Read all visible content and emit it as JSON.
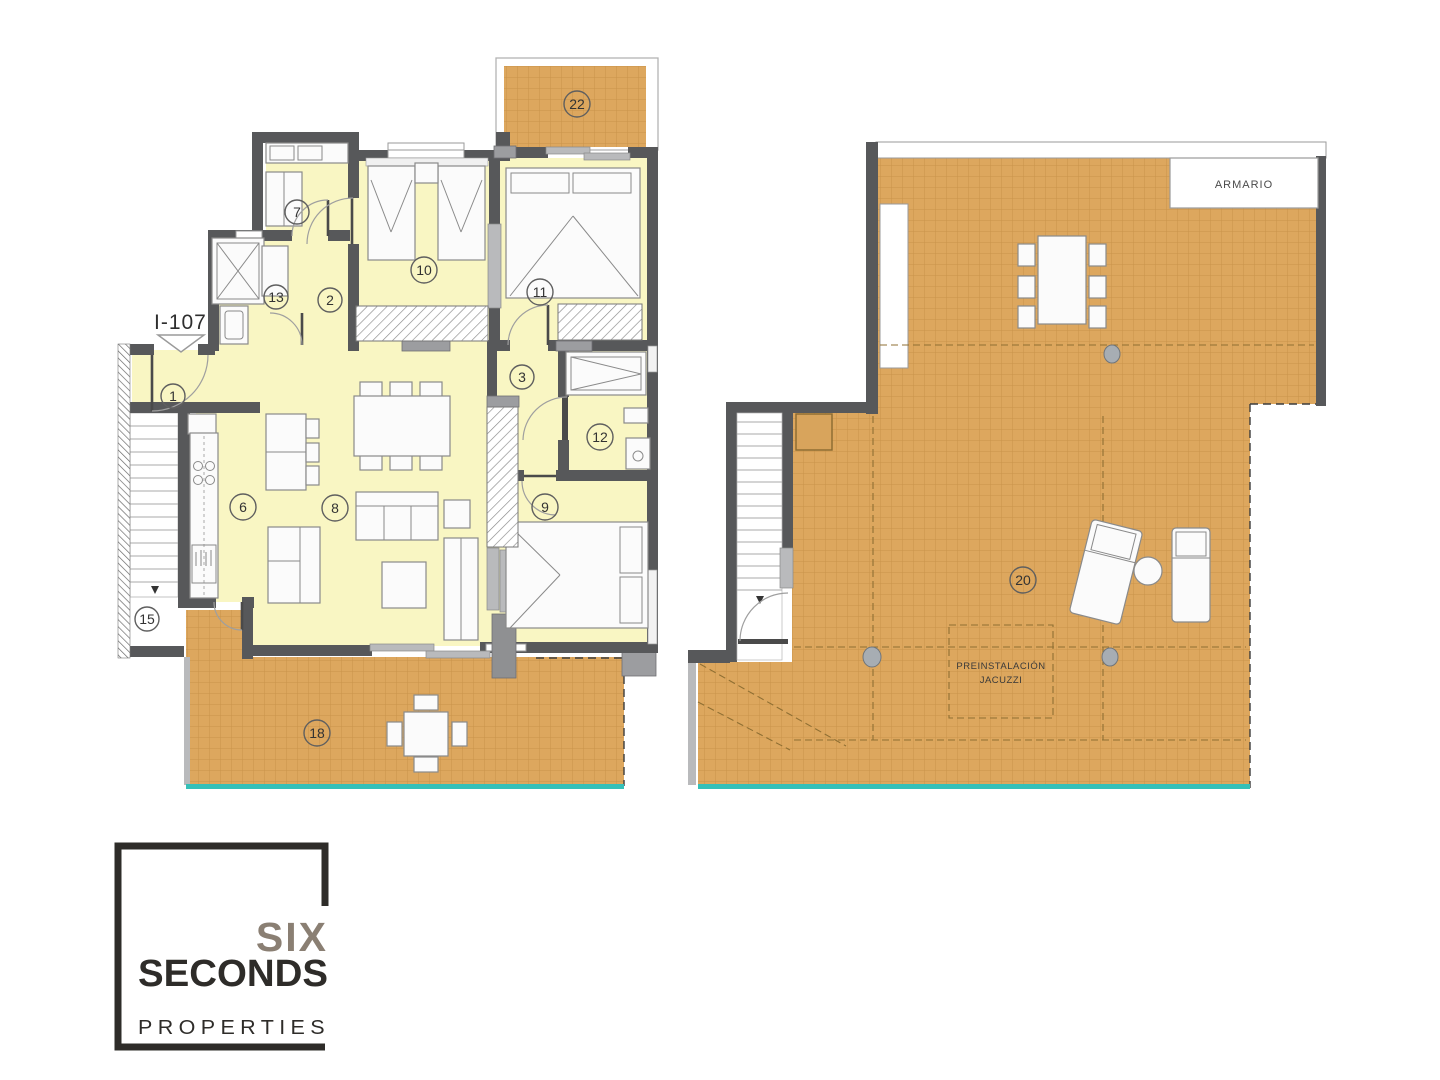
{
  "title": "Apartment floor plan I-107",
  "plan_left": {
    "unit_label": "I-107",
    "rooms": [
      {
        "num": "22"
      },
      {
        "num": "7"
      },
      {
        "num": "13"
      },
      {
        "num": "2"
      },
      {
        "num": "10"
      },
      {
        "num": "11"
      },
      {
        "num": "3"
      },
      {
        "num": "1"
      },
      {
        "num": "12"
      },
      {
        "num": "6"
      },
      {
        "num": "8"
      },
      {
        "num": "9"
      },
      {
        "num": "15"
      },
      {
        "num": "18"
      }
    ]
  },
  "plan_right": {
    "room_num": "20",
    "closet_label": "ARMARIO",
    "jacuzzi_line1": "PREINSTALACIÓN",
    "jacuzzi_line2": "JACUZZI"
  },
  "logo": {
    "word1": "SIX",
    "word2": "SECONDS",
    "word3": "PROPERTIES"
  },
  "colors": {
    "room_fill": "#f9f6c3",
    "terrace_fill": "#dda75e",
    "wall": "#57585a",
    "pool_edge": "#35c0b8",
    "logo_dark": "#2e2c29",
    "logo_gray": "#8a7f73"
  }
}
